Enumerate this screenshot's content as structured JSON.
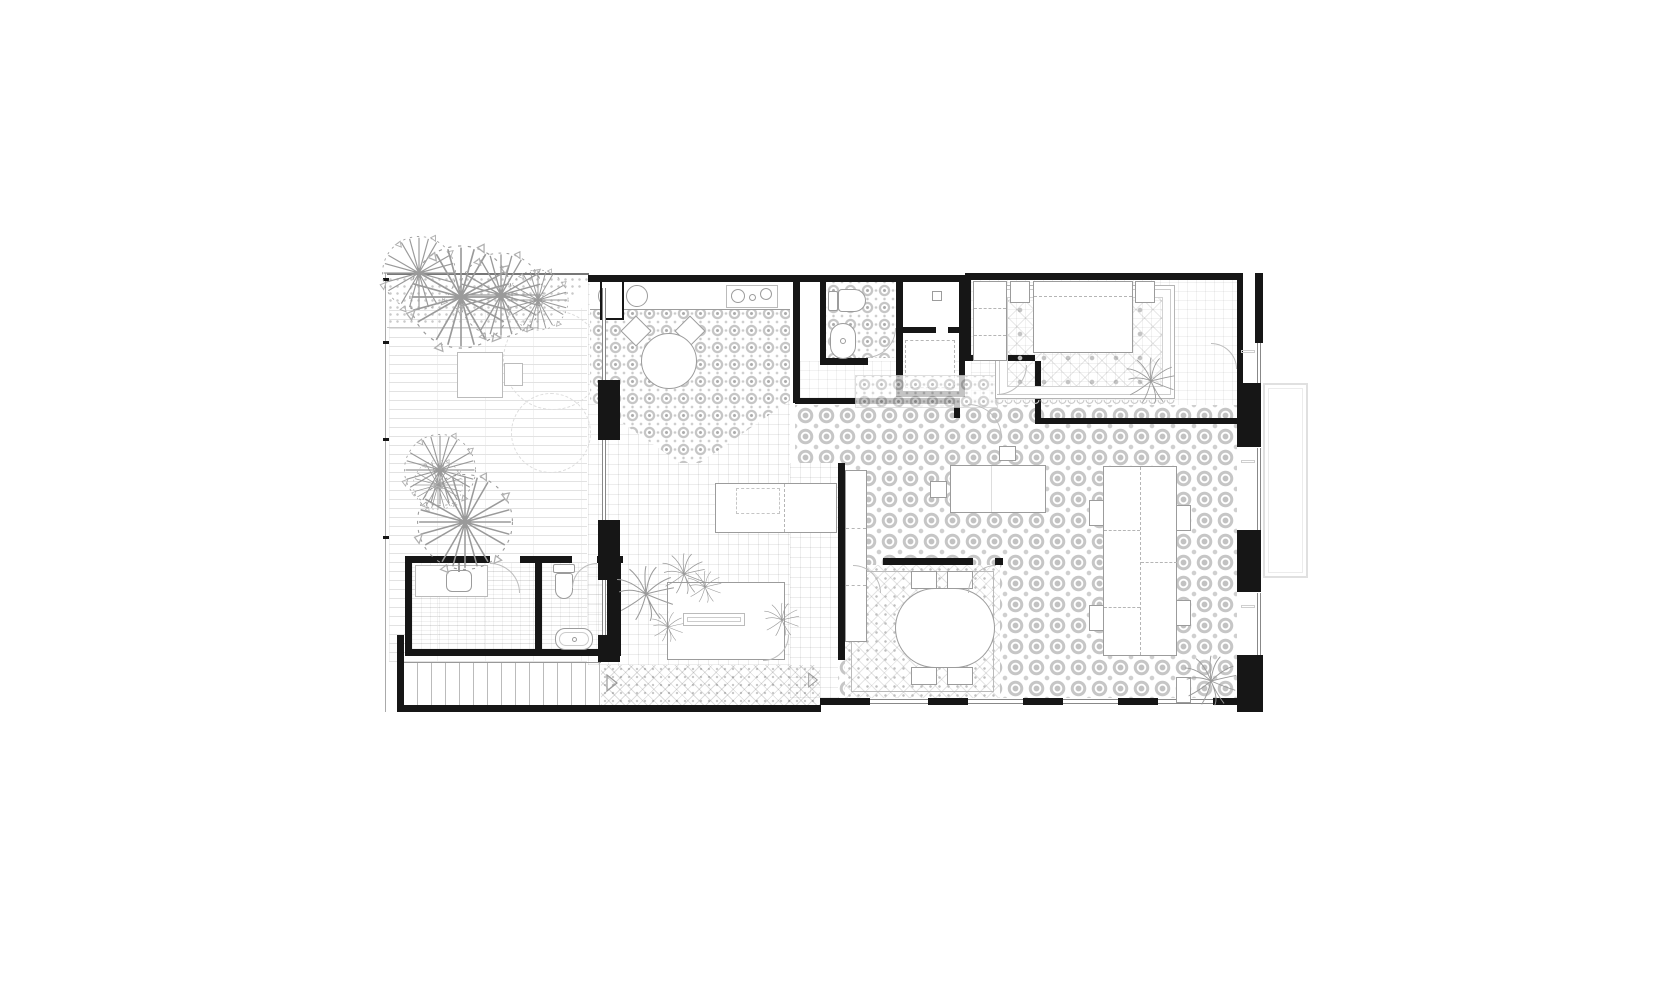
{
  "palette": {
    "paper": "#ffffff",
    "wall": "#161616",
    "ink": "#9c9c9c",
    "soft": "#c9c9c9",
    "pat": "#c6c6c6",
    "faint": "#e2e2e2"
  },
  "drawing": {
    "kind": "residential floor plan, grayscale architectural line drawing, no text labels",
    "rooms": [
      {
        "id": "garden-patio",
        "features": [
          "planting-bed",
          "trees",
          "striped-pavers",
          "patio-table",
          "patio-chair"
        ]
      },
      {
        "id": "utility-room",
        "features": [
          "counter",
          "laundry-sink"
        ]
      },
      {
        "id": "wc",
        "features": [
          "toilet",
          "small-bathtub"
        ]
      },
      {
        "id": "staircase",
        "features": [
          "treads",
          "direction-arrow"
        ]
      },
      {
        "id": "kitchen-living",
        "features": [
          "counter-with-sinks",
          "cooktop",
          "ornate-tile-diamond",
          "round-table",
          "two-chairs",
          "grid-tiles",
          "planter-bench",
          "plants",
          "patterned-walkway"
        ]
      },
      {
        "id": "bathroom",
        "features": [
          "toilet",
          "oval-sink",
          "ornate-tiles",
          "door-arc"
        ]
      },
      {
        "id": "shower-room",
        "features": [
          "floor-drain"
        ]
      },
      {
        "id": "closet",
        "features": [
          "dashed-front"
        ]
      },
      {
        "id": "hallway",
        "features": [
          "ornate-runner-rug"
        ]
      },
      {
        "id": "bedroom",
        "features": [
          "double-bed",
          "two-nightstands",
          "wardrobe",
          "ornate-rug-with-scalloped-border",
          "palm-plant",
          "gallery-windows"
        ]
      },
      {
        "id": "great-room",
        "features": [
          "circle-pattern-tiles",
          "long-table-with-side-chairs",
          "island-desk",
          "stool",
          "tall-cabinet",
          "palm-plant",
          "window-wall"
        ]
      },
      {
        "id": "dining-nook",
        "features": [
          "oval-table",
          "four-chairs",
          "fine-pattern-tiles"
        ]
      },
      {
        "id": "balcony",
        "features": [
          "open-outline"
        ]
      }
    ],
    "annotations": {
      "boundary-ticks": 4,
      "direction-arrows": 2,
      "door-swing-arcs": 9,
      "window-openings": "bottom and right exterior walls"
    }
  }
}
